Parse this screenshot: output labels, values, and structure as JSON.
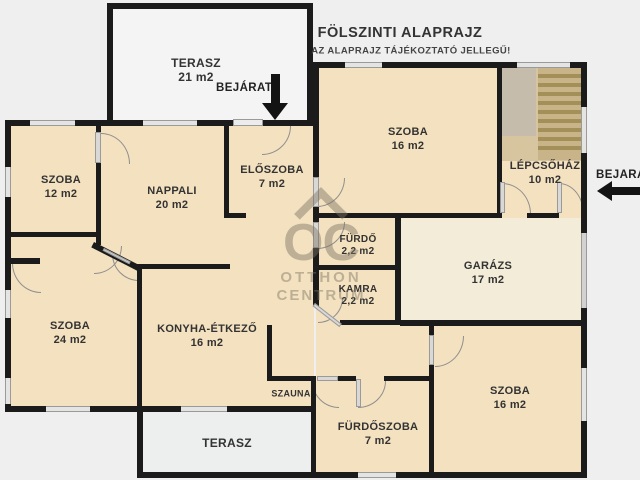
{
  "title": {
    "main": "FÖLSZINTI ALAPRAJZ",
    "subtitle": "AZ ALAPRAJZ TÁJÉKOZTATÓ JELLEGŰ!"
  },
  "entrances": {
    "top_label": "BEJÁRAT",
    "right_label": "BEJÁRAT"
  },
  "watermark": {
    "initials": "OC",
    "line1": "OTTHON",
    "line2": "CENTRUM"
  },
  "rooms": {
    "terasz_top": {
      "name": "TERASZ",
      "area": "21 m2"
    },
    "szoba_tr": {
      "name": "SZOBA",
      "area": "16 m2"
    },
    "lepcsohaz": {
      "name": "LÉPCSŐHÁZ",
      "area": "10 m2"
    },
    "szoba12": {
      "name": "SZOBA",
      "area": "12 m2"
    },
    "nappali": {
      "name": "NAPPALI",
      "area": "20 m2"
    },
    "eloszoba": {
      "name": "ELŐSZOBA",
      "area": "7 m2"
    },
    "furdo": {
      "name": "FÜRDŐ",
      "area": "2,2 m2"
    },
    "kamra": {
      "name": "KAMRA",
      "area": "2,2 m2"
    },
    "garazs": {
      "name": "GARÁZS",
      "area": "17 m2"
    },
    "szoba24": {
      "name": "SZOBA",
      "area": "24 m2"
    },
    "konyha": {
      "name": "KONYHA-ÉTKEZŐ",
      "area": "16 m2"
    },
    "szauna": {
      "name": "SZAUNA"
    },
    "furdoszoba": {
      "name": "FÜRDŐSZOBA",
      "area": "7 m2"
    },
    "szoba_br": {
      "name": "SZOBA",
      "area": "16 m2"
    },
    "terasz_bottom": {
      "name": "TERASZ"
    }
  },
  "colors": {
    "background": "#f0eff0",
    "room": "#f3e1bf",
    "garage": "#f2ecd9",
    "terrace": "#f3f3f3",
    "wall": "#1b1b1b",
    "stairs": "#a99560",
    "watermark": "#7d7464"
  }
}
